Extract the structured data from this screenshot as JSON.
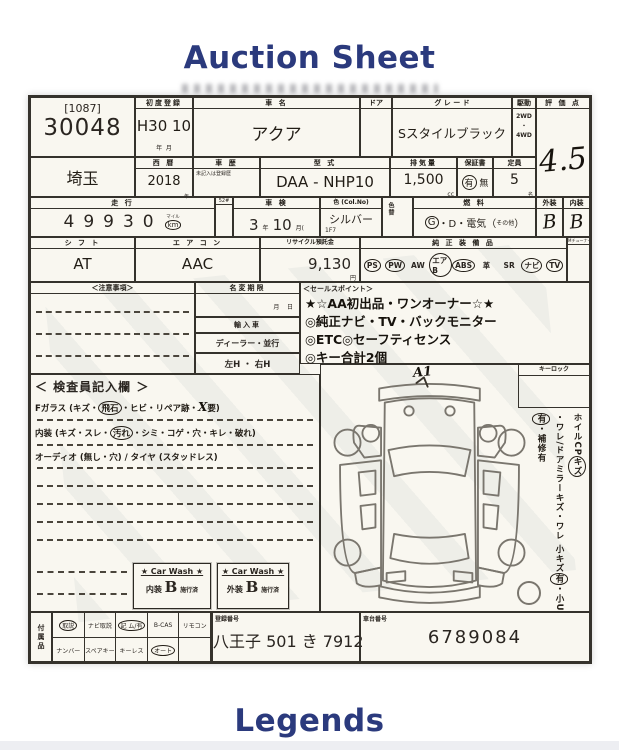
{
  "page": {
    "title": "Auction Sheet",
    "footer": "Legends"
  },
  "colors": {
    "accent": "#2b3a7d",
    "paper": "#f9f7f0",
    "ink": "#2a2520"
  },
  "sheet": {
    "lot": {
      "bracket": "[1087]",
      "number": "30048"
    },
    "first_reg": {
      "label": "初度登録",
      "value": "H30 10",
      "year_unit": "年",
      "month_unit": "月"
    },
    "car_name": {
      "label": "車 名",
      "value": "アクア"
    },
    "door": {
      "label": "ドア"
    },
    "grade": {
      "label": "グ レ ー ド",
      "value": "Sスタイルブラック"
    },
    "drive": {
      "label": "駆動",
      "options": [
        "2WD",
        "・",
        "4WD"
      ]
    },
    "rating": {
      "label": "評 価 点",
      "value": "4.5"
    },
    "prefecture": {
      "value": "埼玉"
    },
    "year": {
      "label": "西 暦",
      "value": "2018",
      "unit": "年"
    },
    "history": {
      "label": "車 歴",
      "note": "未記入は登録歴"
    },
    "model_code": {
      "label": "型 式",
      "value": "DAA -  NHP10"
    },
    "displacement": {
      "label": "排気量",
      "value": "1,500",
      "unit": "cc"
    },
    "warranty": {
      "label": "保証書",
      "segments": [
        {
          "t": "有",
          "c": true
        },
        {
          "t": " 無"
        }
      ]
    },
    "capacity": {
      "label": "定員",
      "value": "5",
      "unit": "名"
    },
    "mileage": {
      "label": "走 行",
      "value": "49930",
      "unit_top": "マイル",
      "unit": "km",
      "side_label": "52#"
    },
    "shaken": {
      "label": "車 検",
      "year": "3",
      "year_unit": "年",
      "month": "10",
      "month_unit": "月("
    },
    "color": {
      "label": "色 (Col.No)",
      "value": "シルバー",
      "code": "1F7",
      "change_label": "色替"
    },
    "fuel": {
      "label": "燃 料",
      "segments": [
        {
          "t": "G",
          "c": true
        },
        {
          "t": "・D・電気（"
        },
        {
          "t": "その他",
          "s": true
        },
        {
          "t": "）"
        }
      ]
    },
    "exterior": {
      "label": "外装",
      "value": "B"
    },
    "interior": {
      "label": "内装",
      "value": "B"
    },
    "shift": {
      "label": "シ フ ト",
      "value": "AT"
    },
    "aircon": {
      "label": "エ ア コ ン",
      "value": "AAC"
    },
    "recycle": {
      "label": "リサイクル預託金",
      "value": "9,130",
      "unit": "円"
    },
    "equipment": {
      "label": "純 正 装 備 品",
      "corner": "Mチューナー",
      "items": [
        {
          "t": "PS",
          "c": true
        },
        {
          "t": "PW",
          "c": true
        },
        {
          "t": "AW"
        },
        {
          "t": "エアB",
          "c": true
        },
        {
          "t": "ABS",
          "c": true
        },
        {
          "t": "革"
        },
        {
          "t": "SR"
        },
        {
          "t": "ナビ",
          "c": true
        },
        {
          "t": "TV",
          "c": true
        }
      ]
    },
    "notes": {
      "label": "＜注意事項＞"
    },
    "regchange": {
      "deadline_label": "名変期限",
      "month": "月",
      "day": "日",
      "import_label": "輸入車",
      "dealer_label": "ディーラー・並行",
      "handle_label": "左H ・ 右H"
    },
    "sales": {
      "label": "＜セールスポイント＞",
      "lines": [
        "★☆AA初出品・ワンオーナー☆★",
        "◎純正ナビ・TV・バックモニター",
        "◎ETC◎セーフティセンス",
        "◎キー合計2個"
      ]
    },
    "inspector": {
      "label": "＜ 検査員記入欄 ＞",
      "line1": [
        {
          "t": "Fガラス (キズ・"
        },
        {
          "t": "飛石",
          "c": true
        },
        {
          "t": "・ヒビ・リペア跡・"
        },
        {
          "t": "X",
          "h": true
        },
        {
          "t": "要)"
        }
      ],
      "line2": [
        {
          "t": "内装 (キズ・スレ・"
        },
        {
          "t": "汚れ",
          "c": true
        },
        {
          "t": "・シミ・コゲ・穴・キレ・破れ)"
        }
      ],
      "line3": [
        {
          "t": "オーディオ (無し・穴) / タイヤ (スタッドレス)"
        }
      ]
    },
    "carwash": {
      "header": "★ Car Wash ★",
      "interior": {
        "prefix": "内装",
        "grade": "B",
        "suffix": "施行済"
      },
      "exterior": {
        "prefix": "外装",
        "grade": "B",
        "suffix": "施行済"
      }
    },
    "car_panel": {
      "keylock_label": "キーロック",
      "hand_mark": "A1",
      "vertical": [
        {
          "t": "ホイルCP"
        },
        {
          "t": "キズ",
          "c": true
        },
        {
          "t": "・ワレ/ドアミラーキズ・ワレ "
        },
        {
          "t": "小キズ"
        },
        {
          "t": "有",
          "c": true
        },
        {
          "t": "・小U"
        },
        {
          "t": "有",
          "c": true
        },
        {
          "t": "・補修有"
        }
      ]
    },
    "accessories": {
      "label": "付属品",
      "row1": [
        {
          "t": "取説",
          "c": true
        },
        {
          "t": "ナビ取説"
        },
        {
          "t": "記 ム/有",
          "c": true
        },
        {
          "t": "B-CAS"
        },
        {
          "t": "リモコン"
        }
      ],
      "row2": [
        {
          "t": "ナンバー"
        },
        {
          "t": "スペアキー"
        },
        {
          "t": "キーレス"
        },
        {
          "t": "オート",
          "c": true
        },
        {
          "t": ""
        }
      ]
    },
    "registration": {
      "label": "登録番号",
      "value": "八王子 501 き 7912"
    },
    "chassis": {
      "label": "車台番号",
      "value": "6789084"
    }
  }
}
